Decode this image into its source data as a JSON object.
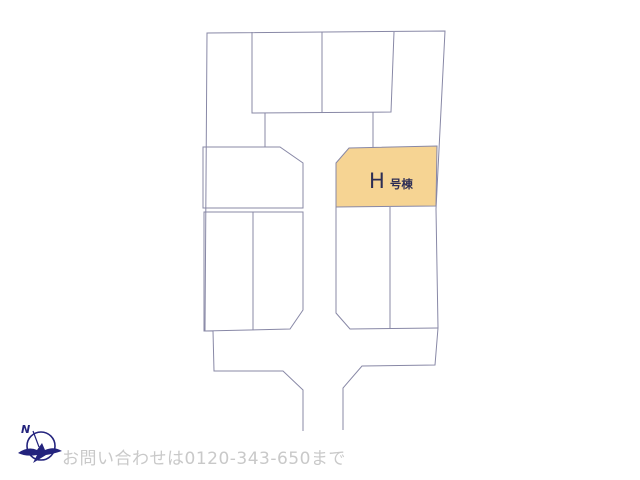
{
  "plan": {
    "stroke_color": "#8888a6",
    "background_color": "#ffffff",
    "highlight": {
      "label_main": "H",
      "label_suffix": "号棟",
      "fill": "#f6d493",
      "label_color": "#2e2e55"
    },
    "shapes": [
      {
        "name": "lot-h-highlighted",
        "closed": true,
        "fill": "#f6d493",
        "points": "336,163 349,148 437,146 436,206 336,207"
      },
      {
        "name": "outer-boundary",
        "closed": false,
        "points": "303,431 303,390 283,371 214,371 213,331 205,331 207,33 445,31 436,209 438,328 435,365 362,366 343,388 343,430"
      },
      {
        "name": "top-lots-outline",
        "closed": false,
        "points": "252,32 252,113 391,112 394,32"
      },
      {
        "name": "top-lot-divider",
        "closed": false,
        "points": "322,32 322,113"
      },
      {
        "name": "road-edge-left",
        "closed": false,
        "points": "265,113 265,147"
      },
      {
        "name": "road-edge-right",
        "closed": false,
        "points": "373,112 373,148"
      },
      {
        "name": "mid-left-lot",
        "closed": true,
        "points": "203,147 280,147 303,163 303,208 203,208"
      },
      {
        "name": "lower-left-lot",
        "closed": true,
        "points": "204,212 303,212 303,310 290,329 204,331"
      },
      {
        "name": "lower-left-lot-divider",
        "closed": false,
        "points": "253,212 253,330"
      },
      {
        "name": "lower-right-lot",
        "closed": false,
        "points": "336,207 336,313 350,329 438,328"
      },
      {
        "name": "lower-right-lot-divider",
        "closed": false,
        "points": "390,207 390,329"
      }
    ]
  },
  "compass": {
    "north_label": "N",
    "color": "#23237d"
  },
  "footer": {
    "contact_text": "お問い合わせは0120-343-650まで",
    "text_color": "#c9c9c9"
  }
}
